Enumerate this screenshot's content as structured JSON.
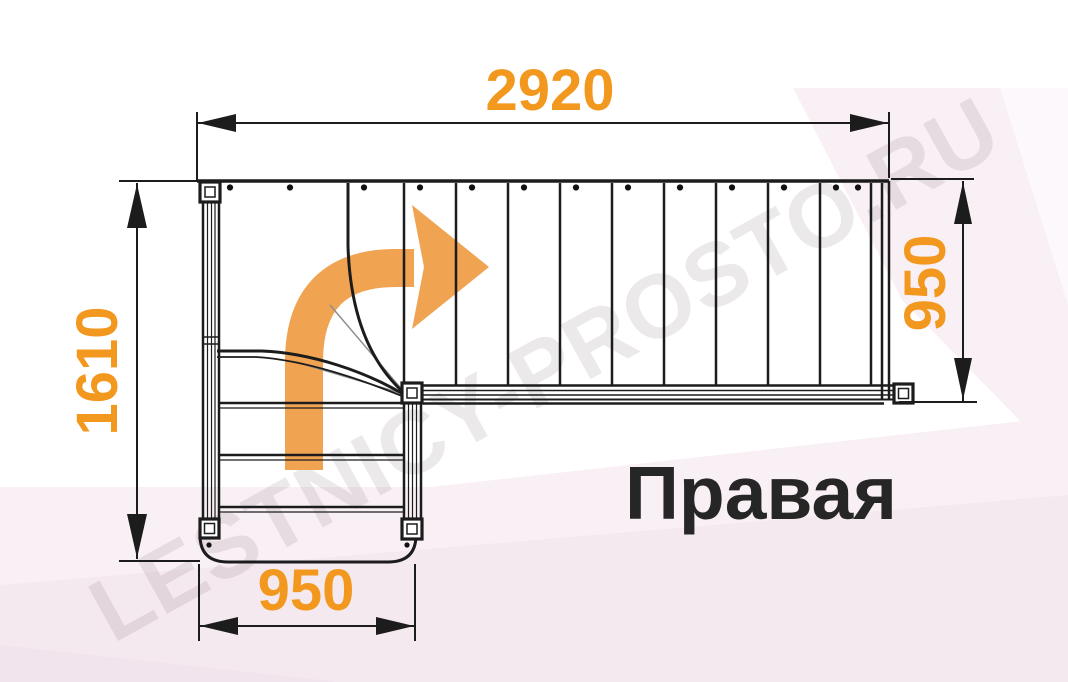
{
  "diagram": {
    "type": "staircase-floor-plan",
    "orientation_label": "Правая",
    "watermark": "LESTNICY-PROSTO.RU",
    "dimensions": {
      "top": "2920",
      "right": "950",
      "left": "1610",
      "bottom": "950"
    },
    "stairs": {
      "upper_flight_riser_lines": 10,
      "lower_flight_step_lines": 3,
      "winder_turn": "90-degree right turn",
      "direction_arrow": "curved-arrow-up-then-right"
    },
    "colors": {
      "dimension_text": "#f2981f",
      "direction_arrow": "#f0a351",
      "line": "#1c1c1c",
      "background_tint": "#f9f0f5"
    }
  }
}
